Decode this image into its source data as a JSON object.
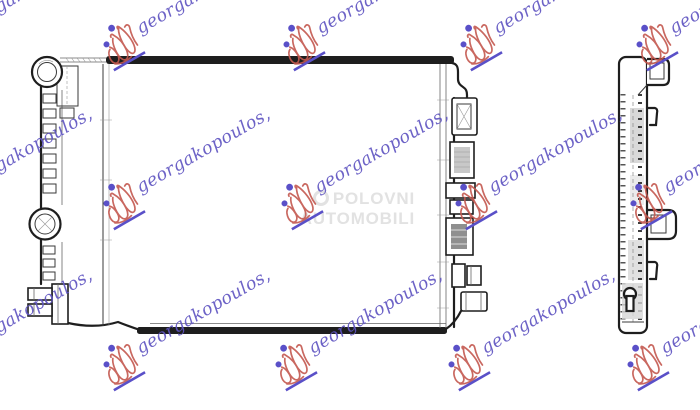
{
  "watermark": {
    "text": "georgakopoulos,",
    "text_color": "#6055c2",
    "logo_color": "#c4584f",
    "dot_color": "#5a50c8",
    "angle_deg": -30,
    "logo_icon": "georgakopoulos-scribble-logo",
    "positions": [
      [
        -71,
        18
      ],
      [
        107,
        18
      ],
      [
        287,
        18
      ],
      [
        464,
        18
      ],
      [
        640,
        18
      ],
      [
        -71,
        177
      ],
      [
        107,
        177
      ],
      [
        285,
        177
      ],
      [
        459,
        177
      ],
      [
        634,
        177
      ],
      [
        -71,
        338
      ],
      [
        107,
        338
      ],
      [
        279,
        338
      ],
      [
        452,
        338
      ],
      [
        631,
        338
      ]
    ]
  },
  "center_badge": {
    "line1": "POLOVNI",
    "line2": "AUTOMOBILI",
    "color": "#e2e2e2",
    "logo_icon": "polovni-automobili-ring"
  },
  "drawing": {
    "line_color": "#1e1e1e",
    "shade_color": "#c8c8c8",
    "views": [
      "radiator-front-view",
      "radiator-side-view"
    ]
  }
}
